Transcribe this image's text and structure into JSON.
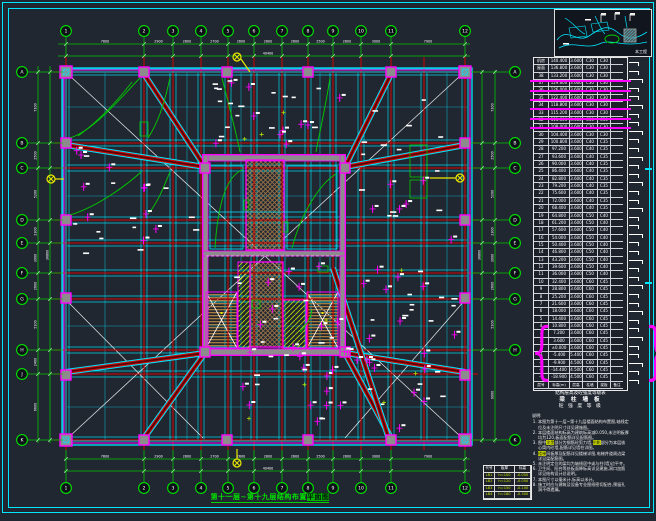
{
  "sheet": {
    "plan_title": {
      "main": "第十一层~第十九层结构布置",
      "highlight": "平面图",
      "tail": ""
    }
  },
  "grid": {
    "top_labels": [
      "1",
      "2",
      "3",
      "4",
      "5",
      "6",
      "7",
      "8",
      "9",
      "10",
      "11",
      "12"
    ],
    "bottom_labels": [
      "1",
      "2",
      "3",
      "4",
      "5",
      "6",
      "7",
      "8",
      "9",
      "10",
      "11",
      "12"
    ],
    "left_labels": [
      "A",
      "B",
      "C",
      "D",
      "E",
      "F",
      "G",
      "H",
      "J",
      "K"
    ],
    "right_labels": [
      "A",
      "B",
      "C",
      "D",
      "E",
      "F",
      "G",
      "H",
      "K"
    ]
  },
  "dimensions": {
    "top": [
      "7800",
      "2900",
      "2800",
      "2700",
      "2600",
      "2800",
      "2600",
      "2500",
      "2800",
      "3000",
      "7900"
    ],
    "top_total": "40400",
    "left": [
      "7100",
      "2500",
      "5200",
      "2300",
      "3000",
      "2600",
      "5100",
      "2400",
      "6600"
    ],
    "left_total": "36800",
    "right": [
      "7100",
      "2500",
      "5200",
      "2300",
      "3000",
      "2600",
      "5100",
      "9000"
    ],
    "right_total": "36800",
    "bottom": [
      "7800",
      "2900",
      "2800",
      "2700",
      "2600",
      "2800",
      "2600",
      "2500",
      "2800",
      "3000",
      "7900"
    ],
    "bottom_total": "40400"
  },
  "storey_table": {
    "caption": "结构层高及砼强度等级表",
    "sub1": "梁 柱 墙 板",
    "sub2": "砼 强 度 等 级",
    "header": [
      "层号",
      "标高(m)",
      "层高",
      "柱墙",
      "梁板",
      "备注"
    ],
    "rows": [
      [
        "机房",
        "140.400",
        "3.600",
        "C30",
        "C30",
        ""
      ],
      [
        "屋面",
        "136.800",
        "3.600",
        "C30",
        "C30",
        ""
      ],
      [
        "38",
        "133.200",
        "3.600",
        "C30",
        "C30",
        ""
      ],
      [
        "37",
        "129.600",
        "3.600",
        "C30",
        "C30",
        ""
      ],
      [
        "36",
        "126.000",
        "3.600",
        "C30",
        "C30",
        ""
      ],
      [
        "35",
        "122.400",
        "3.600",
        "C30",
        "C30",
        ""
      ],
      [
        "34",
        "118.800",
        "3.600",
        "C30",
        "C30",
        ""
      ],
      [
        "33",
        "115.200",
        "3.600",
        "C30",
        "C30",
        ""
      ],
      [
        "32",
        "111.600",
        "3.600",
        "C30",
        "C30",
        ""
      ],
      [
        "31",
        "108.000",
        "3.600",
        "C30",
        "C30",
        ""
      ],
      [
        "30",
        "104.400",
        "3.600",
        "C30",
        "C30",
        ""
      ],
      [
        "29",
        "100.800",
        "3.600",
        "C40",
        "C35",
        ""
      ],
      [
        "28",
        "97.200",
        "3.600",
        "C40",
        "C35",
        ""
      ],
      [
        "27",
        "93.600",
        "3.600",
        "C40",
        "C35",
        ""
      ],
      [
        "26",
        "90.000",
        "3.600",
        "C40",
        "C35",
        ""
      ],
      [
        "25",
        "86.400",
        "3.600",
        "C40",
        "C35",
        ""
      ],
      [
        "24",
        "82.800",
        "3.600",
        "C40",
        "C35",
        ""
      ],
      [
        "23",
        "79.200",
        "3.600",
        "C40",
        "C35",
        ""
      ],
      [
        "22",
        "75.600",
        "3.600",
        "C40",
        "C35",
        ""
      ],
      [
        "21",
        "72.000",
        "3.600",
        "C40",
        "C35",
        ""
      ],
      [
        "20",
        "68.400",
        "3.600",
        "C40",
        "C35",
        ""
      ],
      [
        "19",
        "64.800",
        "3.600",
        "C50",
        "C40",
        ""
      ],
      [
        "18",
        "61.200",
        "3.600",
        "C50",
        "C40",
        ""
      ],
      [
        "17",
        "57.600",
        "3.600",
        "C50",
        "C40",
        ""
      ],
      [
        "16",
        "54.000",
        "3.600",
        "C50",
        "C40",
        ""
      ],
      [
        "15",
        "50.400",
        "3.600",
        "C50",
        "C40",
        ""
      ],
      [
        "14",
        "46.800",
        "3.600",
        "C50",
        "C40",
        ""
      ],
      [
        "13",
        "43.200",
        "3.600",
        "C50",
        "C40",
        ""
      ],
      [
        "12",
        "39.600",
        "3.600",
        "C50",
        "C40",
        ""
      ],
      [
        "11",
        "36.000",
        "3.600",
        "C50",
        "C40",
        ""
      ],
      [
        "10",
        "32.400",
        "3.600",
        "C60",
        "C45",
        ""
      ],
      [
        "9",
        "28.800",
        "3.600",
        "C60",
        "C45",
        ""
      ],
      [
        "8",
        "25.200",
        "3.600",
        "C60",
        "C45",
        ""
      ],
      [
        "7",
        "21.600",
        "3.600",
        "C60",
        "C45",
        ""
      ],
      [
        "6",
        "18.000",
        "3.600",
        "C60",
        "C45",
        ""
      ],
      [
        "5",
        "14.400",
        "3.600",
        "C60",
        "C45",
        ""
      ],
      [
        "4",
        "10.800",
        "3.600",
        "C60",
        "C45",
        ""
      ],
      [
        "3",
        "7.200",
        "3.600",
        "C60",
        "C45",
        ""
      ],
      [
        "2",
        "3.600",
        "3.600",
        "C60",
        "C45",
        ""
      ],
      [
        "1",
        "±0.000",
        "3.600",
        "C60",
        "C45",
        ""
      ],
      [
        "-1",
        "-5.400",
        "5.400",
        "C60",
        "C45",
        ""
      ],
      [
        "-2",
        "-9.900",
        "4.500",
        "C60",
        "C45",
        ""
      ],
      [
        "-3",
        "-14.400",
        "4.500",
        "C60",
        "C45",
        ""
      ],
      [
        "-4",
        "-18.900",
        "4.500",
        "C60",
        "C45",
        ""
      ]
    ]
  },
  "notes": {
    "label": "说明:",
    "items": [
      "本图为第十一层~第十九层楼面结构布置图,轴线定位及未注明尺寸详见建施图。",
      "本层楼面结构标高为建筑标高减0.050,未注明板厚均为120,板面配筋详见配筋图。",
      "图中«涂黑»部分为钢筋砼剪力墙,«阴影»部分为本层核心筒内砼墙,配筋详见墙柱详图。",
      "«楼梯»间板厚及配筋详见楼梯详图,电梯井道周边梁详见梁配筋图。",
      "未注明定位的梁均为轴线居中或与柱(墙)边平齐。",
      "卫生间、阳台等处板面降标高详见建施,洞口加筋详见结构设计总说明。",
      "本图尺寸以毫米计,标高以米计。",
      "施工时应与建筑及设备专业图纸密切配合,预留孔洞不得遗漏。"
    ]
  },
  "slab_table": {
    "header": [
      "代号",
      "板厚",
      "标高"
    ],
    "rows": [
      [
        "LB1",
        "h=100",
        "-0.050"
      ],
      [
        "LB2",
        "h=120",
        "-0.050"
      ],
      [
        "LB3",
        "h=150",
        "-0.100"
      ],
      [
        "LB4",
        "h=180",
        "-0.300"
      ]
    ]
  },
  "site_map": {
    "label": "本工程"
  }
}
